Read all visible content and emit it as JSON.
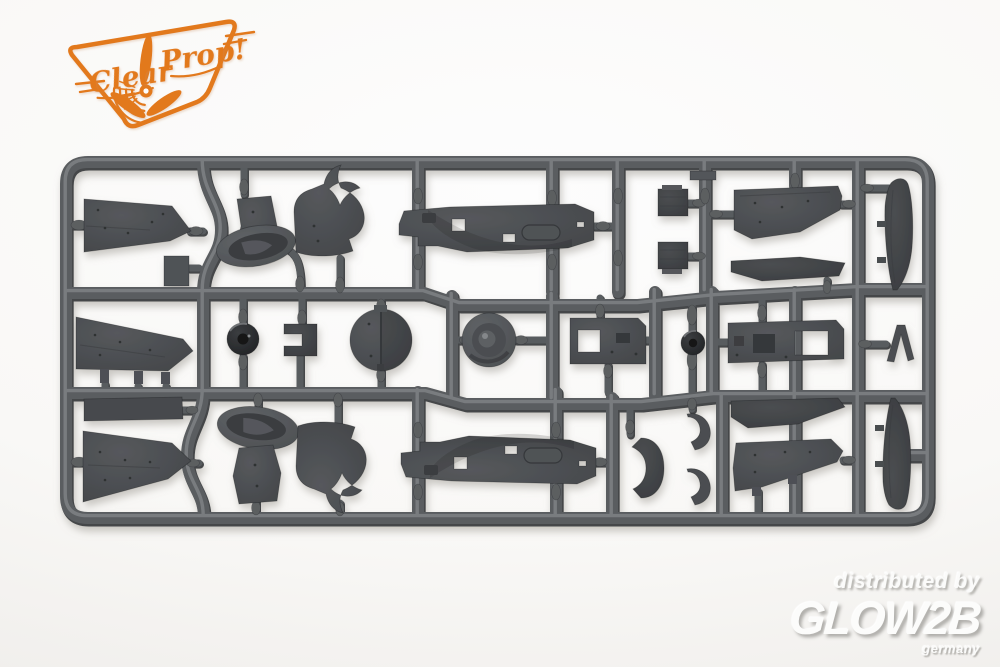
{
  "logo": {
    "brand_word_1": "Clear",
    "brand_word_2": "Prop!",
    "color": "#E2791E"
  },
  "watermark": {
    "line1": "distributed by",
    "brand": "GLOW2B",
    "sub": "germany"
  },
  "photo": {
    "subject": "dark grey injection-molded aircraft model kit sprue",
    "plastic_color": "#55585C",
    "background_color": "#F8F7F5",
    "parts": [
      "wing-panel-upper-left",
      "cockpit-sidewall-upper",
      "engine-cowl-ring-upper",
      "cowl-flap-section-upper",
      "fuselage-half-upper",
      "radiator-block-a",
      "radiator-block-b",
      "wing-panel-upper-right",
      "aileron-strip-upper-right",
      "rudder-half-upper",
      "wing-panel-middle-left",
      "tail-wheel",
      "landing-gear-bracket",
      "fuselage-bulkhead-disc",
      "propeller-spinner",
      "engine-mount-block",
      "wheel-hub",
      "wing-spar-box",
      "windscreen-frame",
      "access-panel",
      "wing-panel-lower-left",
      "engine-cowl-ring-lower",
      "cockpit-sidewall-lower",
      "cowl-flap-section-lower",
      "fuselage-half-lower",
      "cowl-crescent-small",
      "aileron-strip-lower-right",
      "wing-panel-lower-right",
      "rudder-half-lower"
    ]
  }
}
